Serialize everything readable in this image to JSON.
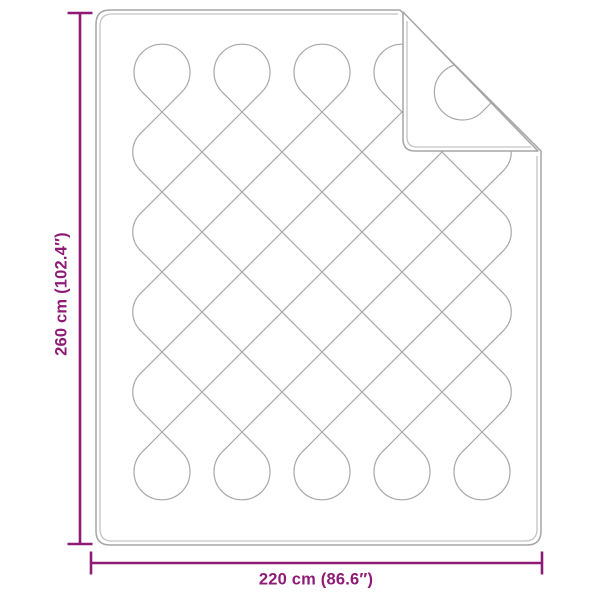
{
  "diagram": {
    "height_label": "260 cm (102.4″)",
    "width_label": "220 cm (86.6″)"
  },
  "colors": {
    "accent": "#8E1C77",
    "outline": "#A5A5A5",
    "outline_inner": "#C4C4C4",
    "stitch": "#A8A8A8"
  }
}
